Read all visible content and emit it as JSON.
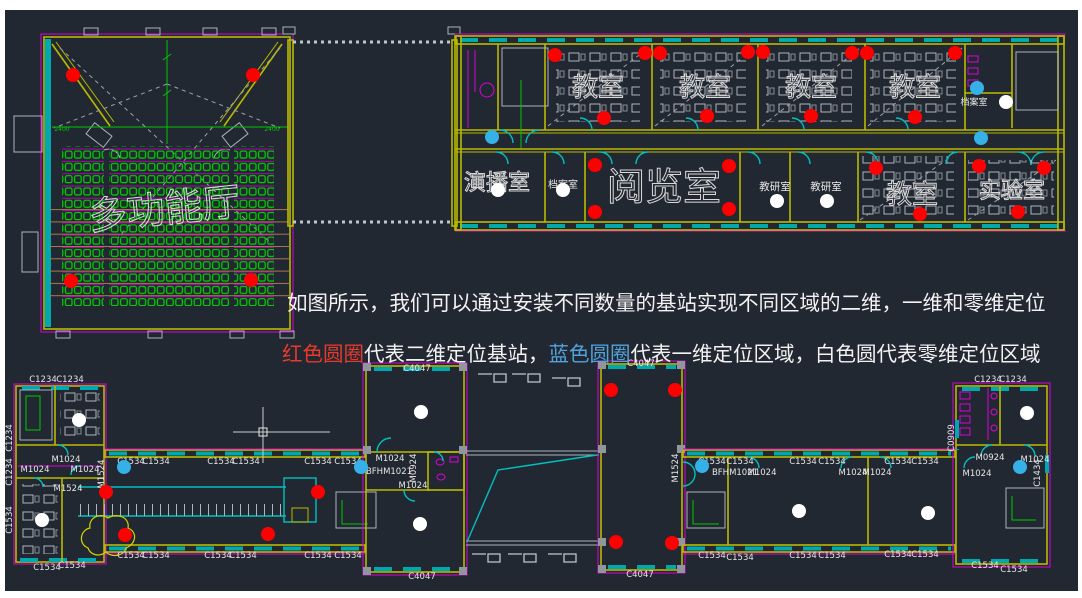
{
  "legend": {
    "line1": "如图所示，我们可以通过安装不同数量的基站实现不同区域的二维，一维和零维定位",
    "segments": [
      {
        "text": "红色圆圈",
        "color": "red"
      },
      {
        "text": "代表二维定位基站，",
        "color": "white"
      },
      {
        "text": "蓝色圆圈",
        "color": "blue"
      },
      {
        "text": "代表一维定位区域，白色圆代表零维定位区域",
        "color": "white"
      }
    ]
  },
  "colors": {
    "background": "#222831",
    "red_marker": "#fe0000",
    "blue_marker": "#35b1e8",
    "white_marker": "#ffffff",
    "wall_yellow": "#b9b900",
    "magenta": "#dc00dc",
    "cyan": "#00c0c0",
    "seat_green": "#00d400",
    "text_red": "#e8392c",
    "text_blue": "#52a3dc"
  },
  "markers": {
    "red": [
      [
        73,
        75
      ],
      [
        253,
        75
      ],
      [
        71,
        281
      ],
      [
        251,
        280
      ],
      [
        555,
        55
      ],
      [
        645,
        53
      ],
      [
        660,
        53
      ],
      [
        748,
        52
      ],
      [
        763,
        52
      ],
      [
        852,
        53
      ],
      [
        867,
        53
      ],
      [
        955,
        53
      ],
      [
        604,
        118
      ],
      [
        707,
        116
      ],
      [
        811,
        116
      ],
      [
        915,
        117
      ],
      [
        595,
        165
      ],
      [
        729,
        166
      ],
      [
        595,
        212
      ],
      [
        729,
        209
      ],
      [
        876,
        168
      ],
      [
        920,
        214
      ],
      [
        979,
        166
      ],
      [
        1044,
        168
      ],
      [
        1018,
        212
      ],
      [
        106,
        492
      ],
      [
        125,
        535
      ],
      [
        268,
        534
      ],
      [
        318,
        492
      ],
      [
        611,
        390
      ],
      [
        675,
        390
      ],
      [
        616,
        542
      ],
      [
        672,
        543
      ]
    ],
    "blue": [
      [
        492,
        137
      ],
      [
        977,
        88
      ],
      [
        981,
        138
      ],
      [
        124,
        467
      ],
      [
        361,
        467
      ],
      [
        702,
        466
      ],
      [
        1020,
        467
      ]
    ],
    "white": [
      [
        498,
        190
      ],
      [
        563,
        190
      ],
      [
        777,
        201
      ],
      [
        827,
        201
      ],
      [
        1006,
        102
      ],
      [
        79,
        420
      ],
      [
        42,
        520
      ],
      [
        421,
        412
      ],
      [
        420,
        524
      ],
      [
        799,
        511
      ],
      [
        928,
        513
      ],
      [
        1027,
        413
      ]
    ]
  },
  "room_labels": [
    {
      "t": "多功能厅",
      "x": 166,
      "y": 222,
      "s": 38,
      "o": 1,
      "rot": -6
    },
    {
      "t": "教室",
      "x": 598,
      "y": 96,
      "s": 26,
      "o": 1
    },
    {
      "t": "教室",
      "x": 705,
      "y": 96,
      "s": 26,
      "o": 1
    },
    {
      "t": "教室",
      "x": 811,
      "y": 96,
      "s": 26,
      "o": 1
    },
    {
      "t": "教室",
      "x": 915,
      "y": 96,
      "s": 26,
      "o": 1
    },
    {
      "t": "教室",
      "x": 912,
      "y": 203,
      "s": 26,
      "o": 1
    },
    {
      "t": "演播室",
      "x": 497,
      "y": 190,
      "s": 22,
      "o": 1
    },
    {
      "t": "档案室",
      "x": 563,
      "y": 188,
      "s": 10
    },
    {
      "t": "阅览室",
      "x": 664,
      "y": 200,
      "s": 38,
      "o": 1
    },
    {
      "t": "教研室",
      "x": 775,
      "y": 190,
      "s": 10.5
    },
    {
      "t": "教研室",
      "x": 826,
      "y": 190,
      "s": 10.5
    },
    {
      "t": "实验室",
      "x": 1012,
      "y": 198,
      "s": 22,
      "o": 1
    },
    {
      "t": "档案室",
      "x": 974,
      "y": 105,
      "s": 9
    }
  ],
  "tag_labels": [
    {
      "t": "C1234",
      "x": 43,
      "y": 382
    },
    {
      "t": "C1234",
      "x": 70,
      "y": 382
    },
    {
      "t": "C1234",
      "x": 988,
      "y": 382
    },
    {
      "t": "C1234",
      "x": 1013,
      "y": 382
    },
    {
      "t": "C1234",
      "x": 12,
      "y": 438,
      "v": 1
    },
    {
      "t": "C1234",
      "x": 12,
      "y": 472,
      "v": 1
    },
    {
      "t": "C1534",
      "x": 12,
      "y": 520,
      "v": 1
    },
    {
      "t": "C1534",
      "x": 131,
      "y": 464
    },
    {
      "t": "C1534",
      "x": 156,
      "y": 464
    },
    {
      "t": "C1534",
      "x": 221,
      "y": 464
    },
    {
      "t": "C1534",
      "x": 246,
      "y": 464
    },
    {
      "t": "C1534",
      "x": 318,
      "y": 464
    },
    {
      "t": "C1534",
      "x": 348,
      "y": 464
    },
    {
      "t": "C1534",
      "x": 712,
      "y": 464
    },
    {
      "t": "C1534",
      "x": 740,
      "y": 464
    },
    {
      "t": "C1534",
      "x": 803,
      "y": 464
    },
    {
      "t": "C1534",
      "x": 832,
      "y": 464
    },
    {
      "t": "C1534",
      "x": 898,
      "y": 464
    },
    {
      "t": "C1534",
      "x": 925,
      "y": 464
    },
    {
      "t": "C1534",
      "x": 131,
      "y": 558
    },
    {
      "t": "C1534",
      "x": 156,
      "y": 558
    },
    {
      "t": "C1534",
      "x": 218,
      "y": 558
    },
    {
      "t": "C1534",
      "x": 243,
      "y": 558
    },
    {
      "t": "C1534",
      "x": 318,
      "y": 558
    },
    {
      "t": "C1534",
      "x": 348,
      "y": 558
    },
    {
      "t": "C1534",
      "x": 712,
      "y": 558
    },
    {
      "t": "C1534",
      "x": 740,
      "y": 560
    },
    {
      "t": "C1534",
      "x": 803,
      "y": 558
    },
    {
      "t": "C1534",
      "x": 832,
      "y": 558
    },
    {
      "t": "C1534",
      "x": 898,
      "y": 557
    },
    {
      "t": "C1534",
      "x": 925,
      "y": 557
    },
    {
      "t": "C1534",
      "x": 47,
      "y": 570
    },
    {
      "t": "C1534",
      "x": 72,
      "y": 568
    },
    {
      "t": "C1534",
      "x": 985,
      "y": 568
    },
    {
      "t": "C1534",
      "x": 1014,
      "y": 572
    },
    {
      "t": "C4047",
      "x": 417,
      "y": 371
    },
    {
      "t": "C4047",
      "x": 422,
      "y": 579
    },
    {
      "t": "C4047",
      "x": 641,
      "y": 366
    },
    {
      "t": "C4047",
      "x": 640,
      "y": 577
    },
    {
      "t": "M1024",
      "x": 66,
      "y": 462
    },
    {
      "t": "M1024",
      "x": 35,
      "y": 472
    },
    {
      "t": "M1024",
      "x": 85,
      "y": 472
    },
    {
      "t": "M1024",
      "x": 390,
      "y": 461
    },
    {
      "t": "M1024",
      "x": 413,
      "y": 488
    },
    {
      "t": "M1024",
      "x": 762,
      "y": 475
    },
    {
      "t": "M1024",
      "x": 853,
      "y": 475
    },
    {
      "t": "M1024",
      "x": 877,
      "y": 475
    },
    {
      "t": "M1024",
      "x": 977,
      "y": 476
    },
    {
      "t": "M1024",
      "x": 1035,
      "y": 462
    },
    {
      "t": "M1524",
      "x": 68,
      "y": 491
    },
    {
      "t": "M1524",
      "x": 104,
      "y": 474,
      "v": 1
    },
    {
      "t": "M1524",
      "x": 678,
      "y": 468,
      "v": 1
    },
    {
      "t": "M0924",
      "x": 416,
      "y": 468,
      "v": 1
    },
    {
      "t": "M0924",
      "x": 990,
      "y": 460
    },
    {
      "t": "BFHM1021",
      "x": 389,
      "y": 474
    },
    {
      "t": "BFHM1021",
      "x": 735,
      "y": 475
    },
    {
      "t": "C0909",
      "x": 954,
      "y": 438,
      "v": 1
    },
    {
      "t": "C1434",
      "x": 1040,
      "y": 473,
      "v": 1
    },
    {
      "t": "2400",
      "x": 62,
      "y": 131,
      "s": 6,
      "c": "#00c800"
    },
    {
      "t": "2400",
      "x": 272,
      "y": 131,
      "s": 6,
      "c": "#00c800"
    }
  ]
}
